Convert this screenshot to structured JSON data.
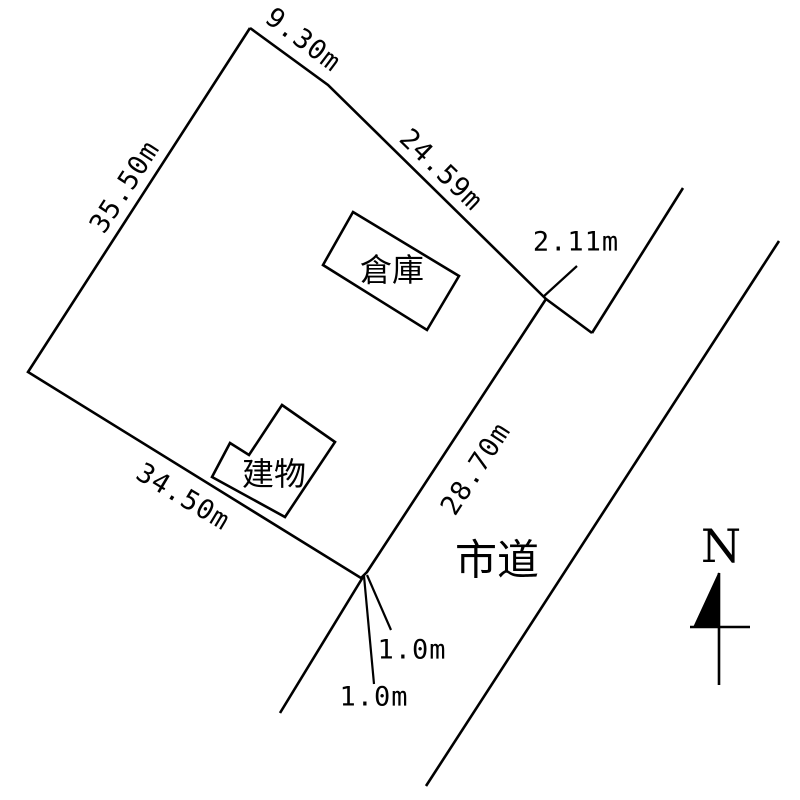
{
  "page": {
    "background_color": "#ffffff",
    "line_color": "#000000",
    "text_color": "#000000"
  },
  "diagram": {
    "canvas": {
      "width": 800,
      "height": 800
    },
    "segments": [
      {
        "name": "parcel-boundary",
        "points": "250,28 328,85 546,299 367,572 361,578 28,372 250,28",
        "width": 2.6
      },
      {
        "name": "boundary-extension",
        "points": "546,299 592,333",
        "width": 2.6
      },
      {
        "name": "road-left-edge-upper",
        "points": "683,188 592,333",
        "width": 2.6
      },
      {
        "name": "road-left-edge-lower",
        "points": "363,577 280,713",
        "width": 2.6
      },
      {
        "name": "road-right-edge",
        "points": "779,241 426,786",
        "width": 2.6
      },
      {
        "name": "dim-tick-2-11m",
        "points": "543,297 577,266",
        "width": 2.2
      },
      {
        "name": "dim-tick-1-0m-right",
        "points": "367,575 391,630",
        "width": 2.2
      },
      {
        "name": "dim-tick-1-0m-left",
        "points": "364,576 374,684",
        "width": 2.2
      }
    ],
    "buildings": [
      {
        "name": "warehouse",
        "label": "倉庫",
        "points": "353,212 459,276 427,330 323,265",
        "label_x": 392,
        "label_y": 270
      },
      {
        "name": "building",
        "label": "建物",
        "points": "282,405 335,442 285,517 212,477 230,443 249,455",
        "label_x": 274,
        "label_y": 474
      }
    ],
    "dimension_labels": [
      {
        "name": "dim-9-30m",
        "text": "9.30m",
        "x": 303,
        "y": 40,
        "rotate": 37
      },
      {
        "name": "dim-24-59m",
        "text": "24.59m",
        "x": 441,
        "y": 170,
        "rotate": 44
      },
      {
        "name": "dim-35-50m",
        "text": "35.50m",
        "x": 125,
        "y": 187,
        "rotate": -57
      },
      {
        "name": "dim-2-11m",
        "text": "2.11m",
        "x": 576,
        "y": 242,
        "rotate": 0
      },
      {
        "name": "dim-28-70m",
        "text": "28.70m",
        "x": 476,
        "y": 469,
        "rotate": -57
      },
      {
        "name": "dim-34-50m",
        "text": "34.50m",
        "x": 183,
        "y": 497,
        "rotate": 31
      },
      {
        "name": "dim-1-0m-right",
        "text": "1.0m",
        "x": 412,
        "y": 650,
        "rotate": 0
      },
      {
        "name": "dim-1-0m-left",
        "text": "1.0m",
        "x": 374,
        "y": 697,
        "rotate": 0
      }
    ],
    "road_label": {
      "text": "市道",
      "x": 497,
      "y": 560
    },
    "north_arrow": {
      "letter": "N",
      "letter_x": 721,
      "letter_y": 546,
      "staff": "719,573 719,685",
      "crossbar": "690,627 750,627",
      "pennant": "719,573 694,627 719,627"
    }
  }
}
